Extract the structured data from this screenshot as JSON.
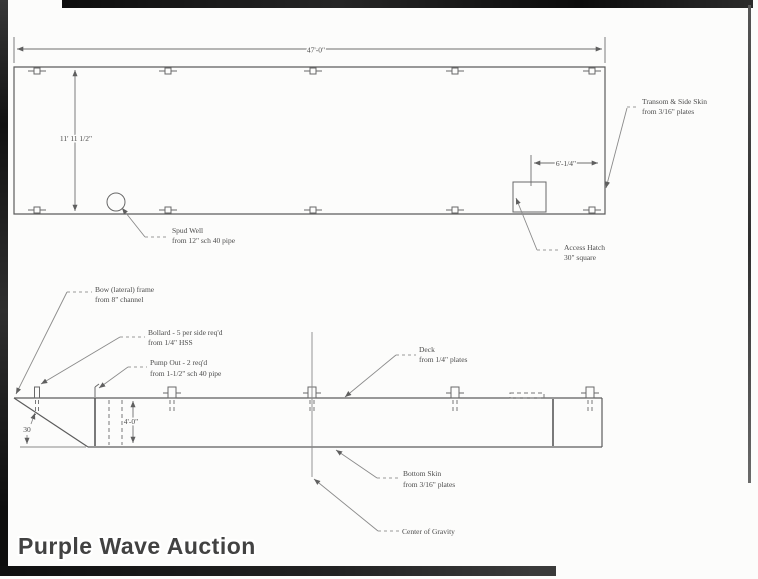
{
  "watermark": "Purple Wave Auction",
  "colors": {
    "ink": "#686868",
    "text": "#4b4b4b",
    "scan_border": "#141414",
    "paper": "#fcfcfb"
  },
  "plan_view": {
    "dim_length": "47'-0\"",
    "dim_width": "11' 11 1/2\"",
    "dim_hatch_offset": "6'-1/4\"",
    "spud_well_label_1": "Spud Well",
    "spud_well_label_2": "from 12\" sch 40 pipe",
    "access_hatch_label_1": "Access Hatch",
    "access_hatch_label_2": "30\" square",
    "transom_label_1": "Transom & Side Skin",
    "transom_label_2": "from 3/16\" plates"
  },
  "side_view": {
    "dim_depth": "4'-0\"",
    "bow_angle": "30",
    "bow_frame_label_1": "Bow (lateral) frame",
    "bow_frame_label_2": "from 8\" channel",
    "bollard_label_1": "Bollard - 5 per side req'd",
    "bollard_label_2": "from 1/4\" HSS",
    "pump_out_label_1": "Pump Out - 2 req'd",
    "pump_out_label_2": "from 1-1/2\" sch 40 pipe",
    "deck_label_1": "Deck",
    "deck_label_2": "from 1/4\" plates",
    "bottom_skin_label_1": "Bottom Skin",
    "bottom_skin_label_2": "from 3/16\" plates",
    "center_of_gravity_label": "Center of Gravity"
  }
}
